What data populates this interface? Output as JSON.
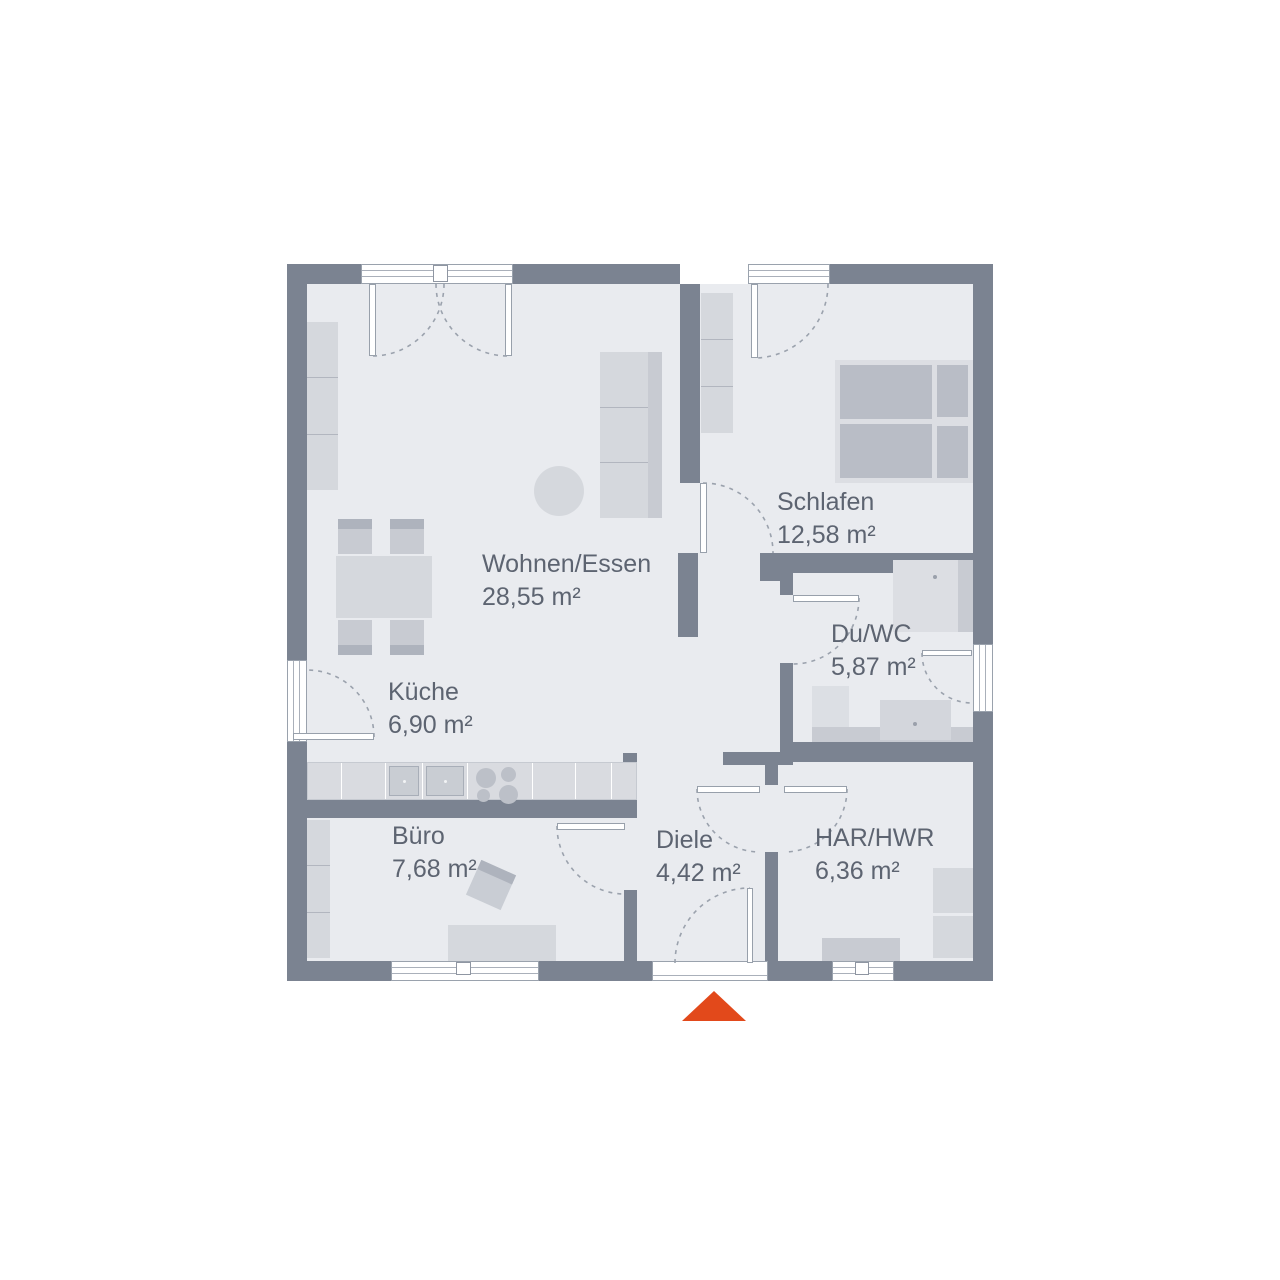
{
  "plan": {
    "colors": {
      "wall": "#7b8391",
      "floor": "#e9ebef",
      "accent": "#e2491b",
      "label_text": "#5d6471"
    },
    "rooms": [
      {
        "id": "wohnen-essen",
        "name": "Wohnen/Essen",
        "area": "28,55 m²"
      },
      {
        "id": "schlafen",
        "name": "Schlafen",
        "area": "12,58 m²"
      },
      {
        "id": "du-wc",
        "name": "Du/WC",
        "area": "5,87 m²"
      },
      {
        "id": "kueche",
        "name": "Küche",
        "area": "6,90 m²"
      },
      {
        "id": "buero",
        "name": "Büro",
        "area": "7,68 m²"
      },
      {
        "id": "diele",
        "name": "Diele",
        "area": "4,42 m²"
      },
      {
        "id": "har-hwr",
        "name": "HAR/HWR",
        "area": "6,36 m²"
      }
    ]
  }
}
